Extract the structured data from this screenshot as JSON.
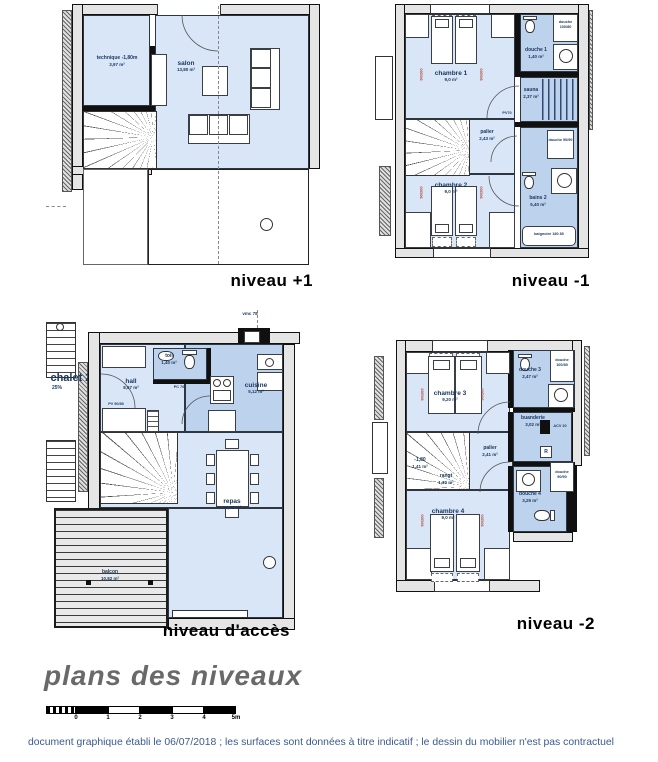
{
  "plans": [
    {
      "id": "niveau-plus-1",
      "title": "niveau +1",
      "rooms": [
        {
          "name": "technique -1,80m",
          "area": "3,97 m²"
        },
        {
          "name": "salon",
          "area": "13,80 m²"
        }
      ]
    },
    {
      "id": "niveau-moins-1",
      "title": "niveau -1",
      "rooms": [
        {
          "name": "chambre 1",
          "area": "9,0 m²"
        },
        {
          "name": "douche 1",
          "area": "1,40 m²"
        },
        {
          "name": "sauna",
          "area": "2,37 m²"
        },
        {
          "name": "palier",
          "area": "2,43 m²"
        },
        {
          "name": "chambre 2",
          "area": "9,0 m²"
        },
        {
          "name": "bains 2",
          "area": "5,40 m²"
        }
      ],
      "fixtures": [
        "douche 100/80",
        "douche 90/90",
        "baignoire 180 80",
        "PV70",
        "90/200"
      ]
    },
    {
      "id": "niveau-acces",
      "title": "niveau d'accès",
      "rooms": [
        {
          "name": "toil",
          "area": "1,40 m²"
        },
        {
          "name": "hall",
          "area": "8,67 m²"
        },
        {
          "name": "cuisine",
          "area": "5,12 m²"
        },
        {
          "name": "repas",
          "area": "16,82 m²"
        },
        {
          "name": "balcon",
          "area": "10,82 m²"
        }
      ],
      "annotations": {
        "chalet": "chalet 25",
        "slope": "25%",
        "flue": "vmc 78",
        "pc": "PC 70",
        "pv": "PV 90/80"
      }
    },
    {
      "id": "niveau-moins-2",
      "title": "niveau -2",
      "rooms": [
        {
          "name": "chambre 3",
          "area": "9,20 m²"
        },
        {
          "name": "douche 3",
          "area": "2,47 m²"
        },
        {
          "name": "buanderie",
          "area": "3,02 m²"
        },
        {
          "name": "palier",
          "area": "2,41 m²"
        },
        {
          "name": "-1,80",
          "area": "1,41 m²"
        },
        {
          "name": "rangt",
          "area": "1,30 m²"
        },
        {
          "name": "chambre 4",
          "area": "9,0 m²"
        },
        {
          "name": "douche 4",
          "area": "3,29 m²"
        }
      ],
      "fixtures": [
        "douche 100/80",
        "douche 90/90",
        "ACV 20",
        "R",
        "90/200"
      ]
    }
  ],
  "footer": {
    "title": "plans des niveaux",
    "scale_ticks": [
      "0",
      "1",
      "2",
      "3",
      "4",
      "5m"
    ],
    "disclaimer": "document graphique établi le 06/07/2018 ; les surfaces sont données à titre indicatif ; le dessin du mobilier n'est pas contractuel"
  },
  "colors": {
    "room_light": "#d9e6f7",
    "room_medium": "#bdd2ed",
    "room_dark": "#a3c2e6",
    "label_navy": "#17365d",
    "dim_orange": "#b04a3a",
    "title_gray": "#696969",
    "disclaimer_blue": "#3a5a8c"
  }
}
